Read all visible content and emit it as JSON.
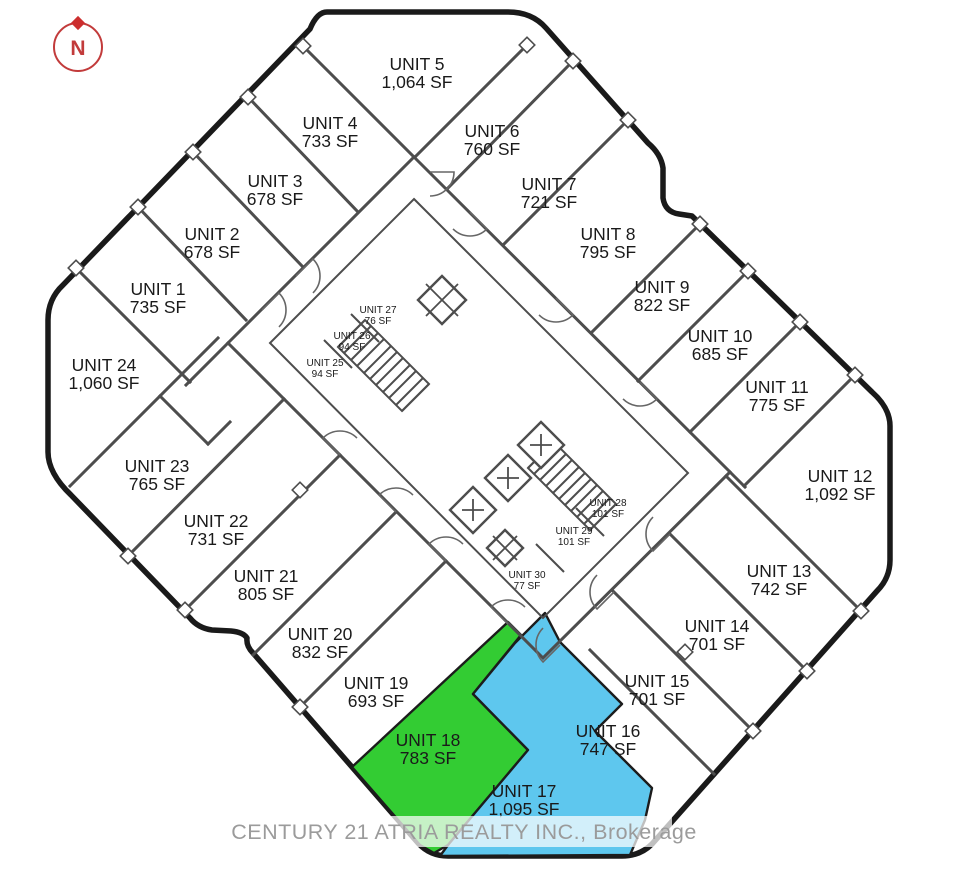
{
  "compass": {
    "label": "N"
  },
  "watermark": {
    "text": "CENTURY 21 ATRIA REALTY INC., Brokerage"
  },
  "highlights": {
    "green": "#33cc33",
    "blue": "#5ec7ee"
  },
  "units": [
    {
      "name": "UNIT 1",
      "area": "735 SF"
    },
    {
      "name": "UNIT 2",
      "area": "678 SF"
    },
    {
      "name": "UNIT 3",
      "area": "678 SF"
    },
    {
      "name": "UNIT 4",
      "area": "733 SF"
    },
    {
      "name": "UNIT 5",
      "area": "1,064 SF"
    },
    {
      "name": "UNIT 6",
      "area": "760 SF"
    },
    {
      "name": "UNIT 7",
      "area": "721 SF"
    },
    {
      "name": "UNIT 8",
      "area": "795 SF"
    },
    {
      "name": "UNIT 9",
      "area": "822 SF"
    },
    {
      "name": "UNIT 10",
      "area": "685 SF"
    },
    {
      "name": "UNIT 11",
      "area": "775 SF"
    },
    {
      "name": "UNIT 12",
      "area": "1,092 SF"
    },
    {
      "name": "UNIT 13",
      "area": "742 SF"
    },
    {
      "name": "UNIT 14",
      "area": "701 SF"
    },
    {
      "name": "UNIT 15",
      "area": "701 SF"
    },
    {
      "name": "UNIT 16",
      "area": "747 SF"
    },
    {
      "name": "UNIT 17",
      "area": "1,095 SF"
    },
    {
      "name": "UNIT 18",
      "area": "783 SF"
    },
    {
      "name": "UNIT 19",
      "area": "693 SF"
    },
    {
      "name": "UNIT 20",
      "area": "832 SF"
    },
    {
      "name": "UNIT 21",
      "area": "805 SF"
    },
    {
      "name": "UNIT 22",
      "area": "731 SF"
    },
    {
      "name": "UNIT 23",
      "area": "765 SF"
    },
    {
      "name": "UNIT 24",
      "area": "1,060 SF"
    },
    {
      "name": "UNIT 25",
      "area": "94 SF"
    },
    {
      "name": "UNIT 26",
      "area": "94 SF"
    },
    {
      "name": "UNIT 27",
      "area": "76 SF"
    },
    {
      "name": "UNIT 28",
      "area": "101  SF"
    },
    {
      "name": "UNIT 29",
      "area": "101  SF"
    },
    {
      "name": "UNIT 30",
      "area": "77  SF"
    }
  ]
}
